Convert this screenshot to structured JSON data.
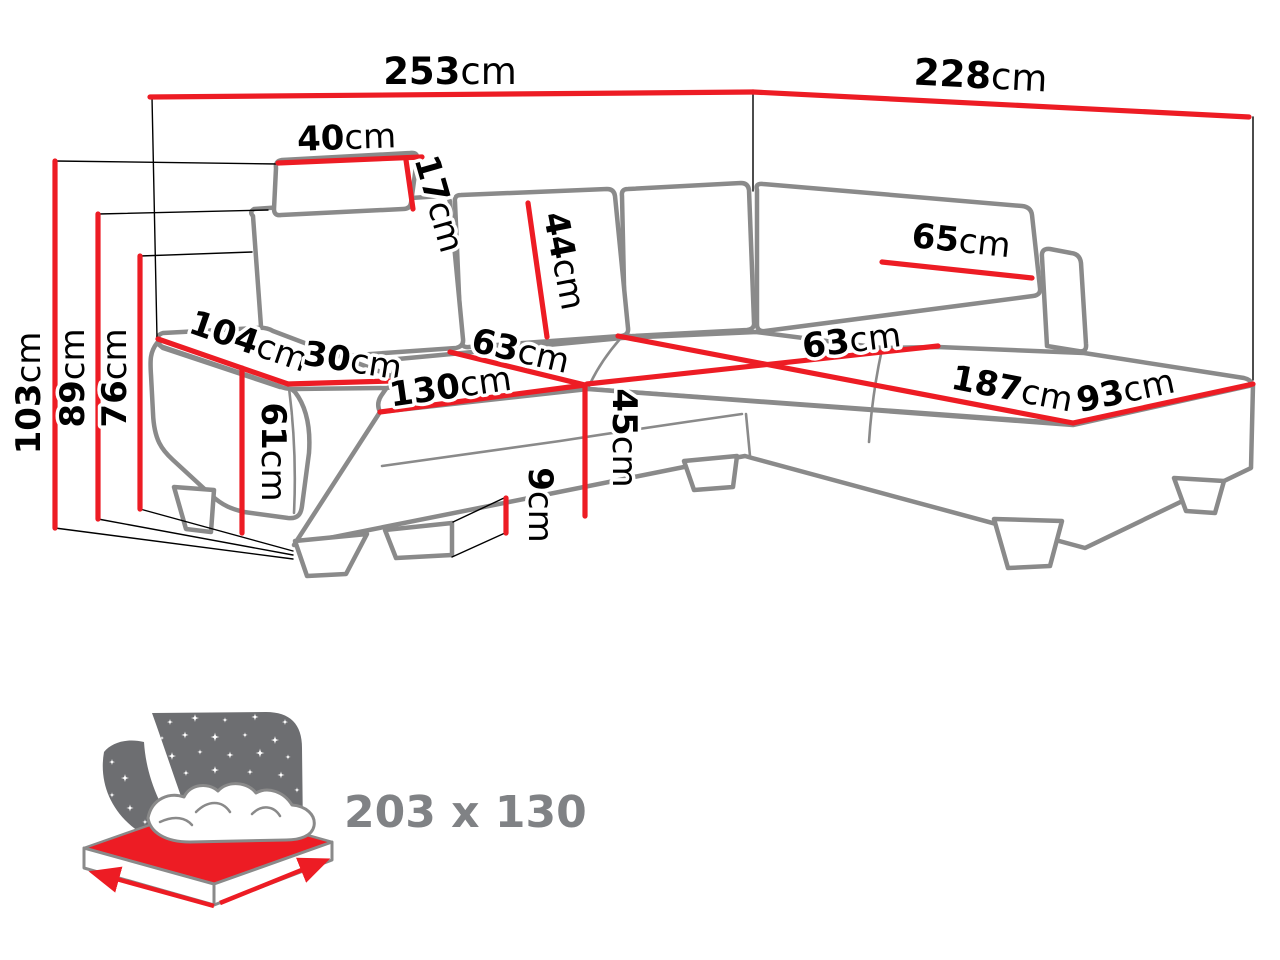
{
  "diagram_title": "corner-sofa-dimensions",
  "measurements": {
    "overall_width_left": {
      "value": "253",
      "unit": "cm"
    },
    "overall_width_right": {
      "value": "228",
      "unit": "cm"
    },
    "height_total": {
      "value": "103",
      "unit": "cm"
    },
    "height_no_headrest": {
      "value": "89",
      "unit": "cm"
    },
    "height_backrest": {
      "value": "76",
      "unit": "cm"
    },
    "headrest_width": {
      "value": "40",
      "unit": "cm"
    },
    "headrest_height": {
      "value": "17",
      "unit": "cm"
    },
    "back_cushion_height": {
      "value": "44",
      "unit": "cm"
    },
    "right_cushion_width": {
      "value": "65",
      "unit": "cm"
    },
    "total_depth": {
      "value": "104",
      "unit": "cm"
    },
    "armrest_width": {
      "value": "30",
      "unit": "cm"
    },
    "armrest_height": {
      "value": "61",
      "unit": "cm"
    },
    "seat_depth_left": {
      "value": "63",
      "unit": "cm"
    },
    "seat_width": {
      "value": "130",
      "unit": "cm"
    },
    "seat_height": {
      "value": "45",
      "unit": "cm"
    },
    "leg_clearance": {
      "value": "9",
      "unit": "cm"
    },
    "seat_depth_right": {
      "value": "63",
      "unit": "cm"
    },
    "chaise_length": {
      "value": "187",
      "unit": "cm"
    },
    "chaise_width": {
      "value": "93",
      "unit": "cm"
    }
  },
  "sleeping_area": {
    "label": "203 x 130"
  },
  "colors": {
    "dimension_red": "#ed1c24",
    "outline_gray": "#8a8a8a",
    "icon_gray": "#6d6e71",
    "icon_text_gray": "#808285",
    "label_black": "#000000"
  }
}
